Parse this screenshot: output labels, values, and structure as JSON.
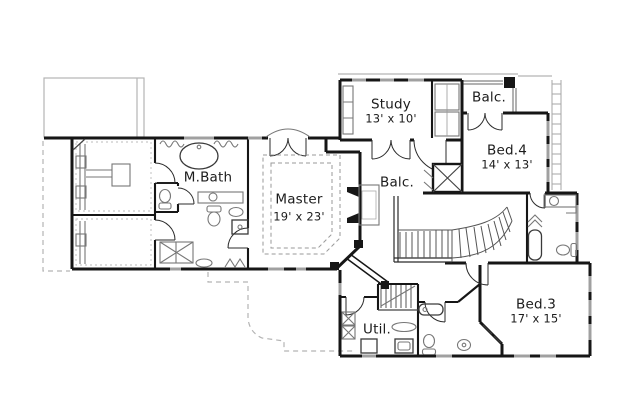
{
  "rooms": {
    "study": {
      "name": "Study",
      "dims": "13' x 10'"
    },
    "balcony_upper": {
      "name": "Balc."
    },
    "bed4": {
      "name": "Bed.4",
      "dims": "14' x 13'"
    },
    "mbath": {
      "name": "M.Bath"
    },
    "master": {
      "name": "Master",
      "dims": "19' x 23'"
    },
    "balcony_overlook": {
      "name": "Balc."
    },
    "bed3": {
      "name": "Bed.3",
      "dims": "17' x 15'"
    },
    "util": {
      "name": "Util."
    }
  },
  "colors": {
    "background": "#ffffff",
    "wall": "#161616",
    "window": "#a0a0a0",
    "fixture": "#777777",
    "roof_outline": "#b4b4b4",
    "text": "#1c1c1c"
  }
}
